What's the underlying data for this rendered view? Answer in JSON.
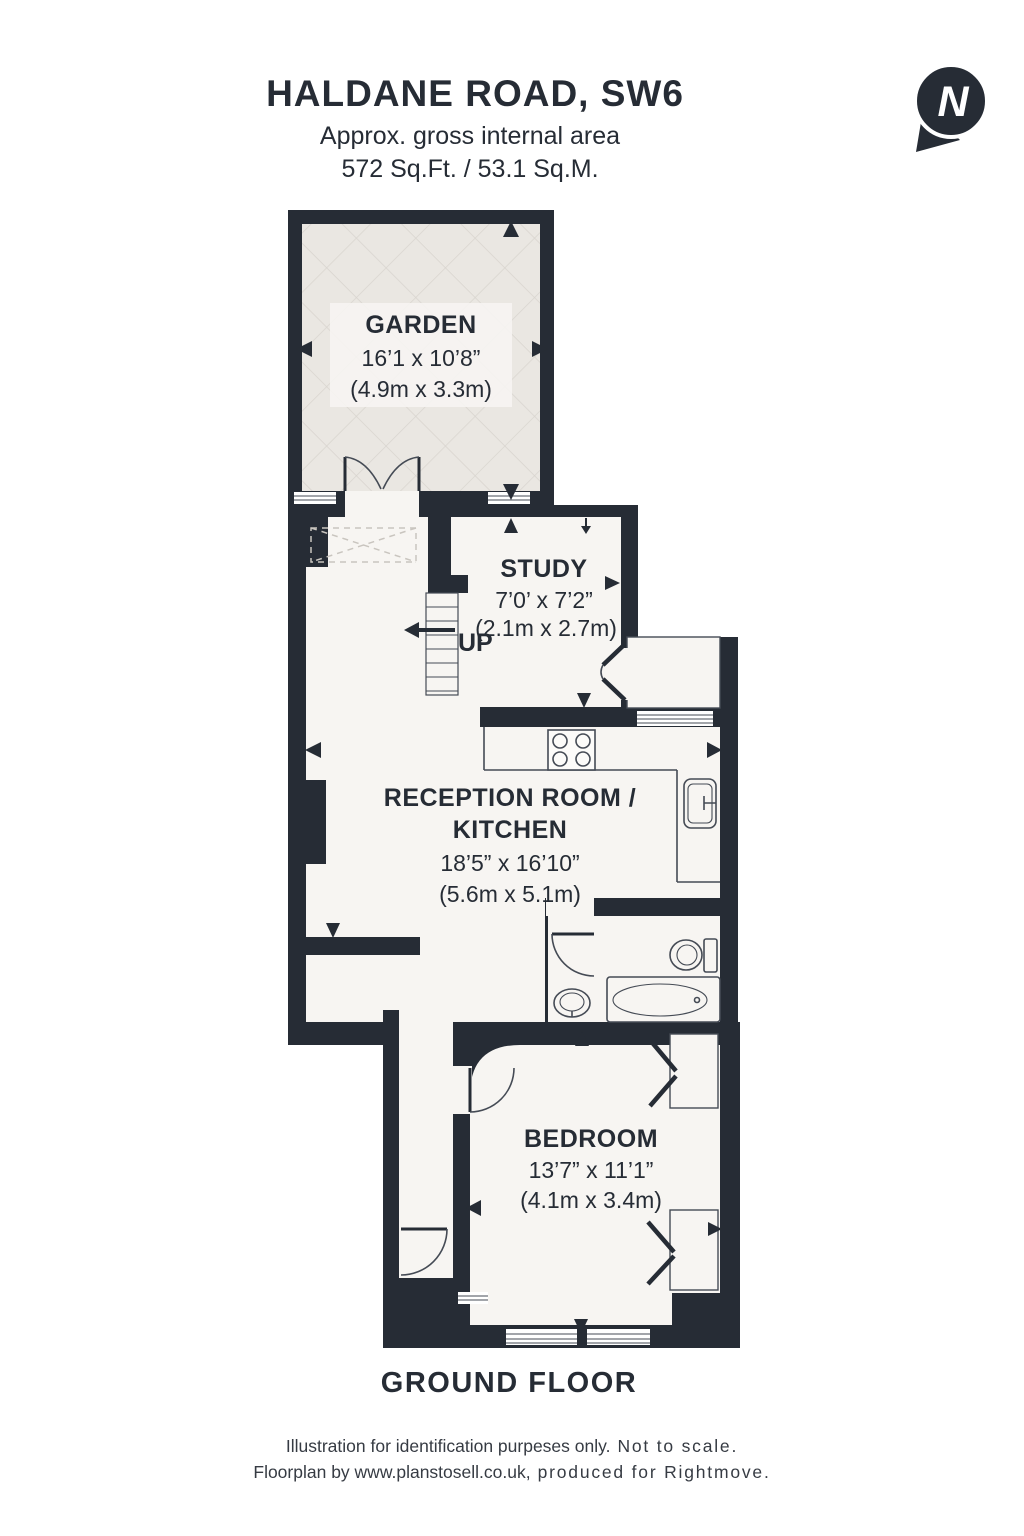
{
  "header": {
    "title": "HALDANE ROAD, SW6",
    "subtitle_line1": "Approx. gross internal area",
    "subtitle_line2": "572 Sq.Ft. / 53.1 Sq.M."
  },
  "compass": {
    "label": "N"
  },
  "rooms": {
    "garden": {
      "name": "GARDEN",
      "imperial": "16’1 x 10’8”",
      "metric": "(4.9m x 3.3m)"
    },
    "study": {
      "name": "STUDY",
      "imperial": "7’0’ x 7’2”",
      "metric": "(2.1m x 2.7m)"
    },
    "reception": {
      "name_line1": "RECEPTION ROOM /",
      "name_line2": "KITCHEN",
      "imperial": "18’5” x 16’10”",
      "metric": "(5.6m x 5.1m)"
    },
    "bedroom": {
      "name": "BEDROOM",
      "imperial": "13’7” x 11’1”",
      "metric": "(4.1m x 3.4m)"
    }
  },
  "stairs": {
    "label": "UP"
  },
  "floor_label": "GROUND FLOOR",
  "footer": {
    "line1_normal": "Illustration for identification purpeses only.",
    "line1_emphasis": "Not to scale.",
    "line2_normal": "Floorplan by www.planstosell.co.uk,",
    "line2_emphasis": "produced for Rightmove."
  },
  "colors": {
    "wall": "#262c35",
    "floor": "#f7f5f2",
    "garden_fill": "#eae7e2",
    "garden_hatch": "#d8d4ce",
    "window_fill": "#ffffff",
    "fixture_line": "#454b55",
    "text": "#262c35"
  }
}
